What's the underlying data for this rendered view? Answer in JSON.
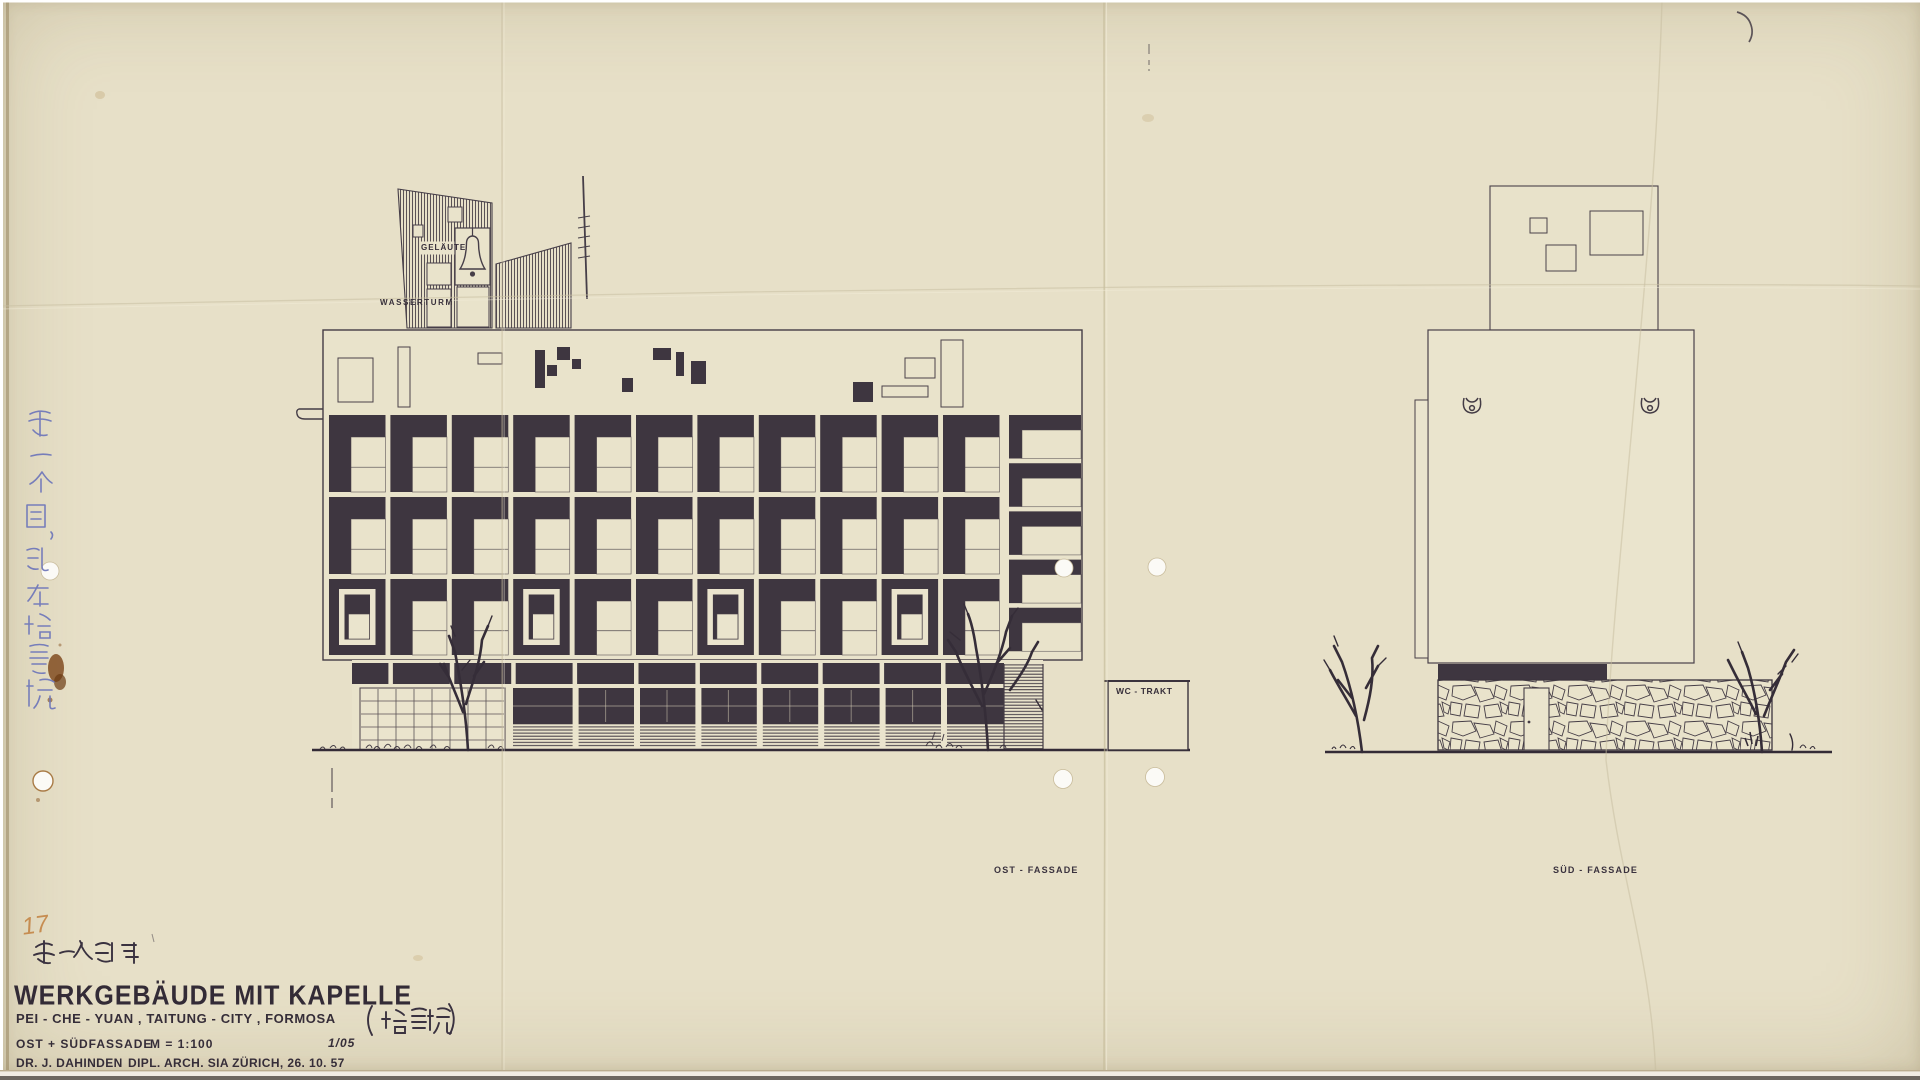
{
  "document": {
    "kind": "scanned architectural elevation drawing, ink on tracing paper"
  },
  "colors": {
    "paper": "#e7e0c8",
    "paper_light": "#eae4cd",
    "ink_fill": "#3e3640",
    "line": "#4a4149",
    "text_ink": "#352d38",
    "blue_ink": "#7179ba",
    "orange_pencil": "#c2803e",
    "stain_brown": "#7a4316"
  },
  "labels": {
    "gelaute": "GELÄUTE",
    "wasserturm": "WASSERTURM",
    "wc_trakt": "WC - TRAKT",
    "ost_fassade": "OST - FASSADE",
    "sud_fassade": "SÜD - FASSADE"
  },
  "annotations": {
    "corner_number": "17",
    "handwritten_note_title_block": "第一次設計",
    "handwritten_note_vertical": "第一个圖，記在培質院",
    "handwritten_name_chinese": "培質院"
  },
  "title_block": {
    "title": "WERKGEBÄUDE MIT KAPELLE",
    "subtitle": "PEI - CHE - YUAN , TAITUNG - CITY , FORMOSA",
    "contents": "OST + SÜDFASSADE",
    "scale": "M = 1:100",
    "sheet": "1/05",
    "architect_name": "DR. J. DAHINDEN",
    "architect_info": "DIPL. ARCH. SIA ZÜRICH, 26. 10. 57"
  },
  "elevations": {
    "ost": {
      "label": "OST - FASSADE",
      "grid": {
        "x0": 329,
        "cols": 11,
        "pitch": 61.4,
        "cell_w": 56.5,
        "bar": 22,
        "rows": [
          [
            415,
            77
          ],
          [
            497,
            77
          ],
          [
            579,
            76
          ]
        ],
        "special_cols": [
          0,
          3,
          6,
          9
        ],
        "right": {
          "x": 1009,
          "w": 72,
          "y0": 415,
          "pitch": 48.2,
          "h": 43.5,
          "bar": 15,
          "lbar": 13,
          "rows": 5
        }
      },
      "attic": {
        "outlined": [
          [
            338,
            358,
            35,
            44
          ],
          [
            398,
            347,
            12,
            60
          ],
          [
            478,
            353,
            24,
            11
          ],
          [
            905,
            358,
            30,
            20
          ],
          [
            941,
            340,
            22,
            67
          ],
          [
            882,
            386,
            46,
            11
          ]
        ],
        "dark": [
          [
            535,
            350,
            10,
            38
          ],
          [
            557,
            347,
            13,
            13
          ],
          [
            547,
            365,
            10,
            11
          ],
          [
            572,
            359,
            9,
            10
          ],
          [
            622,
            378,
            11,
            14
          ],
          [
            653,
            348,
            18,
            12
          ],
          [
            676,
            352,
            8,
            24
          ],
          [
            691,
            361,
            15,
            23
          ],
          [
            853,
            382,
            20,
            20
          ]
        ]
      }
    },
    "sud": {
      "label": "SÜD - FASSADE"
    }
  }
}
